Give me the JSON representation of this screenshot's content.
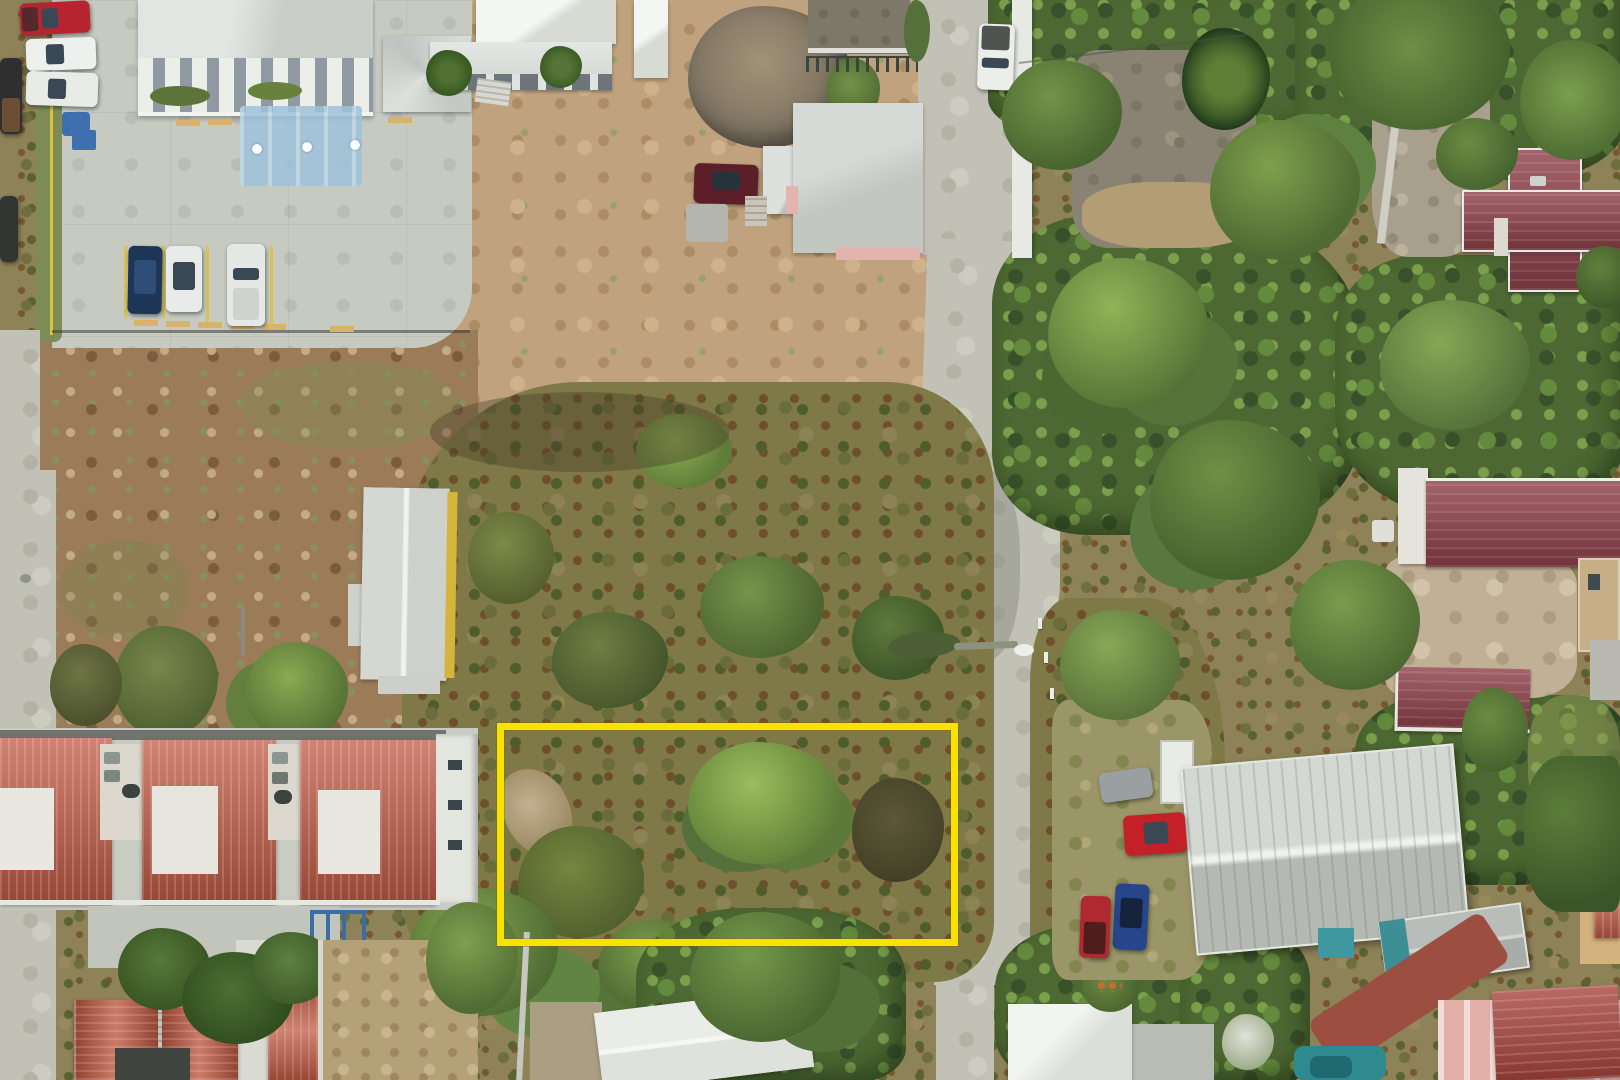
{
  "scene": {
    "kind": "aerial-drone-photo",
    "annotation": {
      "name": "property-boundary",
      "shape": "rectangle",
      "color": "#F6E400",
      "stroke_px": 7,
      "css": "left:497px;top:723px;width:461px;height:223px;border:7px solid #F6E400"
    },
    "inventory": {
      "parking_lot_cars": [
        "red-pickup",
        "white-car",
        "white-car",
        "dark-truck",
        "dark-truck",
        "dark-blue-suv",
        "white-suv",
        "white-pickup"
      ],
      "dirt_lot_cars": [
        "maroon-sedan"
      ],
      "road_vehicles": [
        "white-truck"
      ],
      "driveway_vehicles": [
        "red-hatchback",
        "dark-blue-car",
        "red-pickup",
        "gray-covered-car",
        "small-dark-car"
      ],
      "buildings": [
        "white-colonnade-building",
        "gray-pavilion",
        "white-gable-building",
        "pink-house-gray-roof",
        "yellow-trim-long-building",
        "red-roof-apartment-row",
        "red-gable-cottages",
        "white-hip-roof-house",
        "gray-metal-warehouse",
        "teal-shed",
        "red-cross-gable-house",
        "maroon-long-house",
        "maroon-house",
        "pink-red-roof-house",
        "tan-house"
      ],
      "handicap_bays": 3,
      "fallen_light_pole": 1
    }
  },
  "palette": {
    "boundary_yellow": "#F6E400",
    "terracotta_roof": "#C05A43",
    "maroon_roof": "#8E4149",
    "concrete": "#C6CAC1",
    "dirt": "#C0A37E",
    "scrub": "#7F7847",
    "canopy": "#4D6832",
    "handicap_blue": "#9FC2DB"
  }
}
